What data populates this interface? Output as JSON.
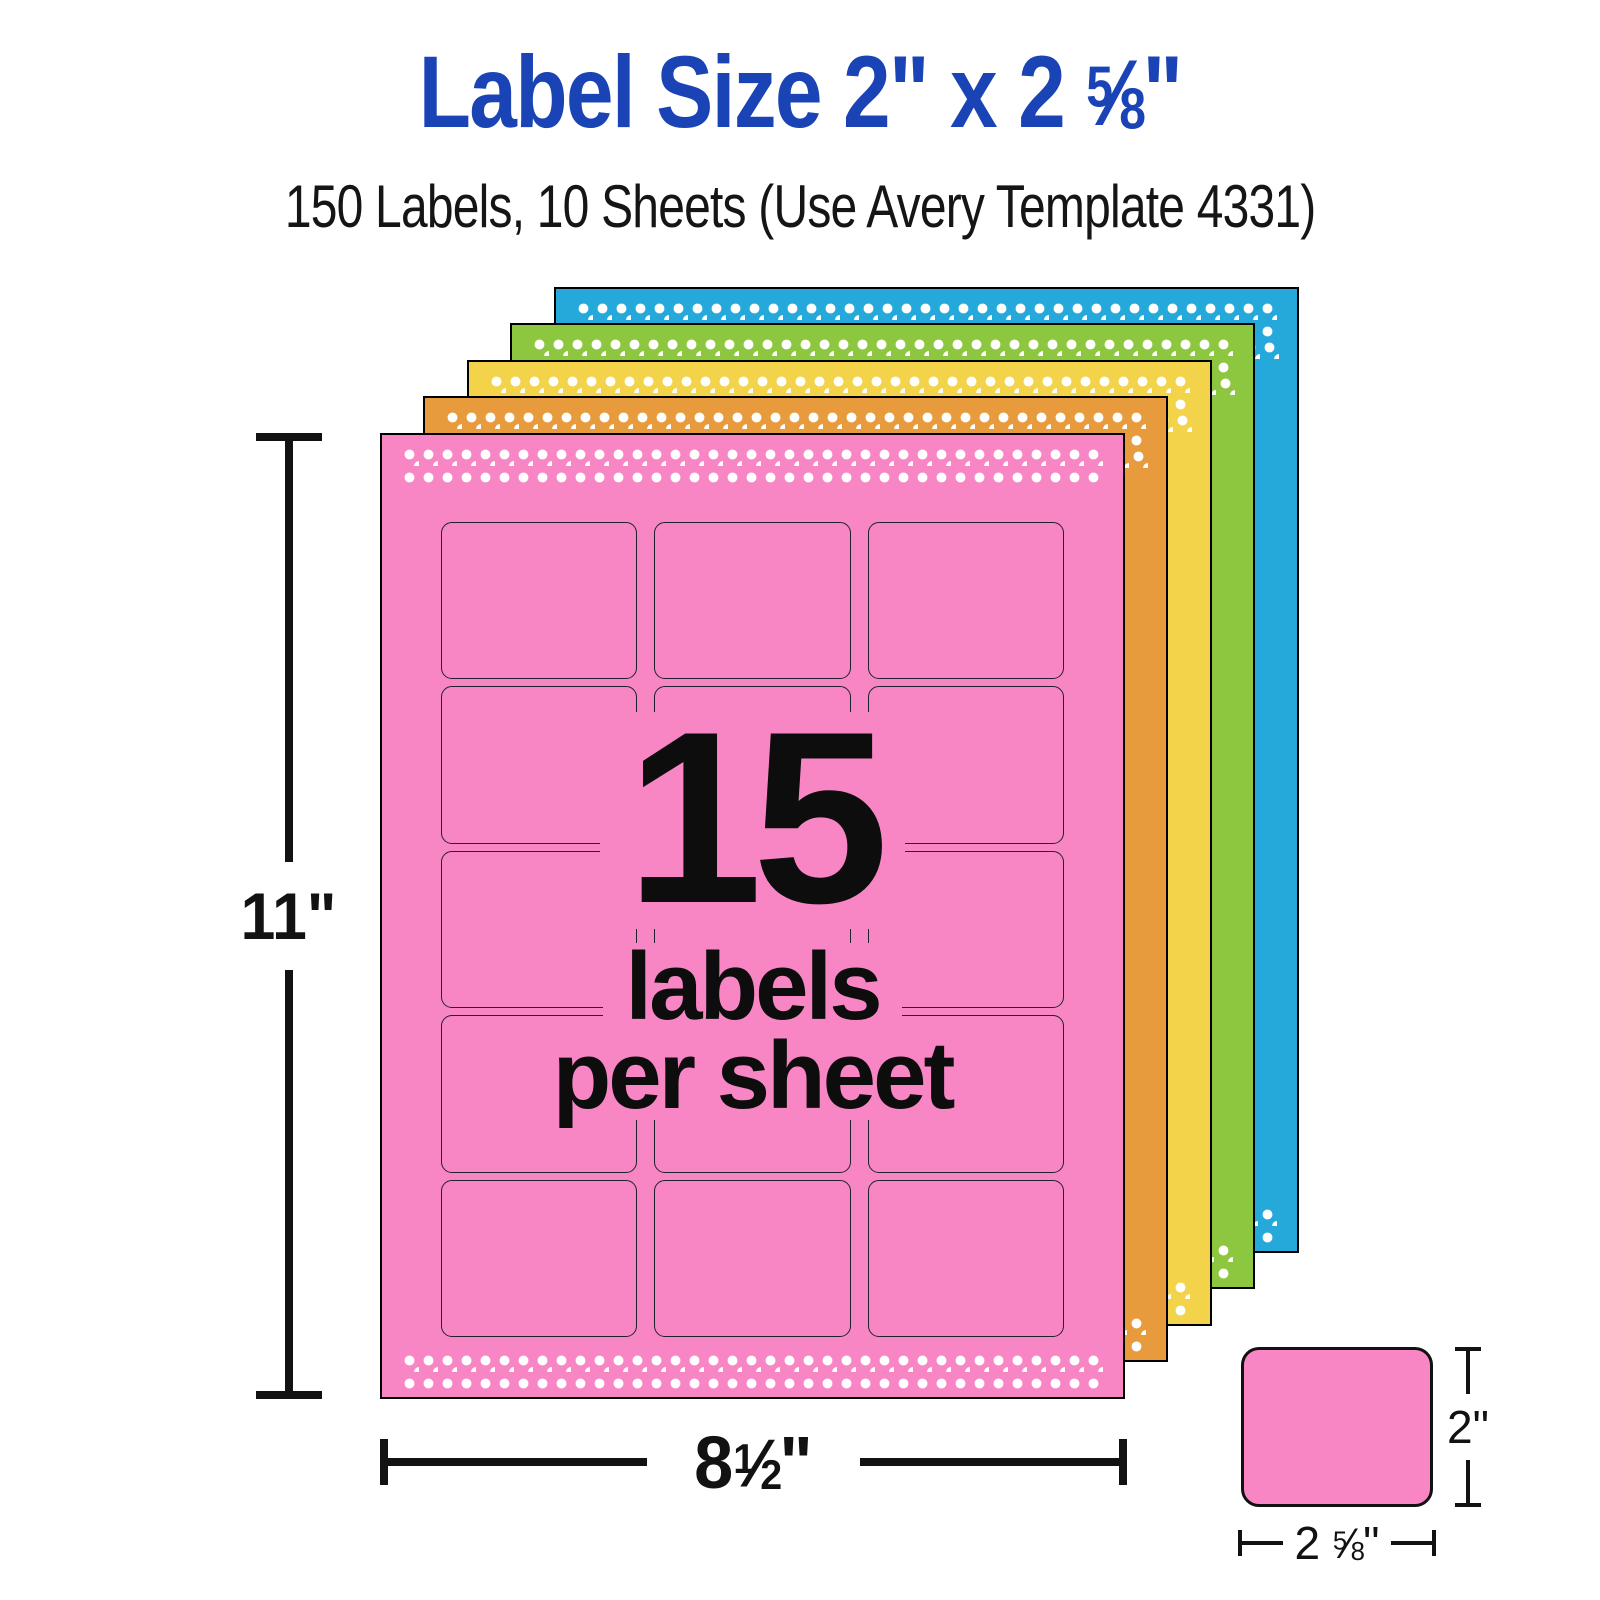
{
  "header": {
    "title": {
      "prefix": "Label Size 2\" x 2 ",
      "frac_num": "5",
      "frac_slash": "⁄",
      "frac_den": "8",
      "suffix": "\""
    },
    "subtitle": "150 Labels, 10 Sheets (Use Avery Template 4331)"
  },
  "colors": {
    "title_blue": "#1a44b5",
    "text_black": "#111111",
    "dot_white": "#ffffff",
    "sheet_outline": "#000000",
    "label_outline": "#20202e",
    "dimension_line": "#121212"
  },
  "sheets": {
    "stack": [
      {
        "name": "blue",
        "color": "#25a9da"
      },
      {
        "name": "green",
        "color": "#8dc63f"
      },
      {
        "name": "yellow",
        "color": "#f2d34a"
      },
      {
        "name": "orange",
        "color": "#e89b3c"
      },
      {
        "name": "pink",
        "color": "#f886c5"
      }
    ],
    "grid": {
      "rows": 5,
      "cols": 3
    },
    "front_text": {
      "count": "15",
      "line2": "labels",
      "line3": "per sheet"
    }
  },
  "dimensions": {
    "sheet_height": "11\"",
    "sheet_width": {
      "prefix": "8",
      "frac_num": "1",
      "frac_slash": "⁄",
      "frac_den": "2",
      "suffix": "\""
    },
    "label_height": "2\"",
    "label_width": {
      "prefix": "2 ",
      "frac_num": "5",
      "frac_slash": "⁄",
      "frac_den": "8",
      "suffix": "\""
    }
  }
}
